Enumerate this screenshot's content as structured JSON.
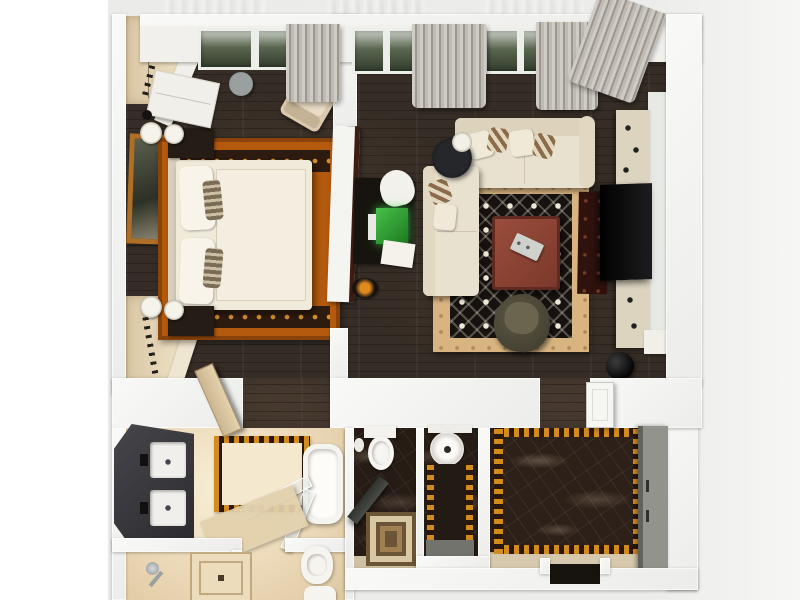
{
  "scene": {
    "type": "3d-floor-plan-render",
    "description": "Top-down 3D render of a one-bedroom apartment",
    "page_background": "#ffffff",
    "render_background": "#ececea"
  },
  "palette": {
    "wall_white": "#f5f5f2",
    "wood_floor": "#362d26",
    "marble_floor": "#271c15",
    "bath_tile": "#ecd9b8",
    "bedroom_rug_orange": "#b45a0e",
    "living_rug_border_tan": "#d8b480",
    "living_rug_field_black": "#17120f",
    "sofa_cream": "#e9e1cf",
    "bed_cream": "#f0eadb",
    "check_gold": "#d28c1e",
    "curtain_gray": "#b5b0a9",
    "wardrobe_gray": "#8f8f89",
    "coffee_table_red": "#8e4537",
    "tv_black": "#0b0b0c",
    "window_glass_green": "#4a5540",
    "desk_lamp_green": "#3fae3f"
  },
  "rooms": [
    {
      "name": "bedroom",
      "floor": "dark hardwood",
      "furniture": [
        "double bed with pillows",
        "orange patterned rug",
        "two nightstands",
        "four table lamps",
        "wardrobe with hangers (top)",
        "wardrobe with hangers (bottom)",
        "white dresser",
        "round side table",
        "beige armchair",
        "framed wall picture",
        "door ajar"
      ]
    },
    {
      "name": "living-room",
      "floor": "dark hardwood",
      "furniture": [
        "L-shaped cream sectional sofa",
        "accent pillows",
        "black round side table with lamp",
        "black patterned rug with tan border",
        "square red-brown coffee table with tray",
        "dark lounge chair",
        "TV wall unit with black TV",
        "cream media cabinets",
        "desk with glowing laptop",
        "white desk chair",
        "dark red floor runner",
        "black decor vase",
        "white console"
      ]
    },
    {
      "name": "bathroom",
      "floor": "beige tile",
      "furniture": [
        "dark double vanity with two sinks",
        "bathtub",
        "glass shower screens",
        "checkered border mat",
        "shower fixture",
        "square drain mat",
        "bidet",
        "toilet (partial)"
      ]
    },
    {
      "name": "wc",
      "floor": "dark marble",
      "furniture": [
        "toilet with tank",
        "paper holder",
        "dark door ajar",
        "layered square mat"
      ]
    },
    {
      "name": "laundry",
      "floor": "dark marble",
      "furniture": [
        "round washing machine (top view)",
        "checker-edged runner",
        "gray mat"
      ]
    },
    {
      "name": "entry-hall",
      "floor": "dark marble",
      "furniture": [
        "large rug with gold checkered border",
        "gray wardrobe",
        "entry door threshold",
        "white interior door"
      ]
    },
    {
      "name": "window-wall",
      "floor": "",
      "furniture": [
        "window bays with greenery",
        "gray drape curtains",
        "city reflection above"
      ]
    }
  ]
}
